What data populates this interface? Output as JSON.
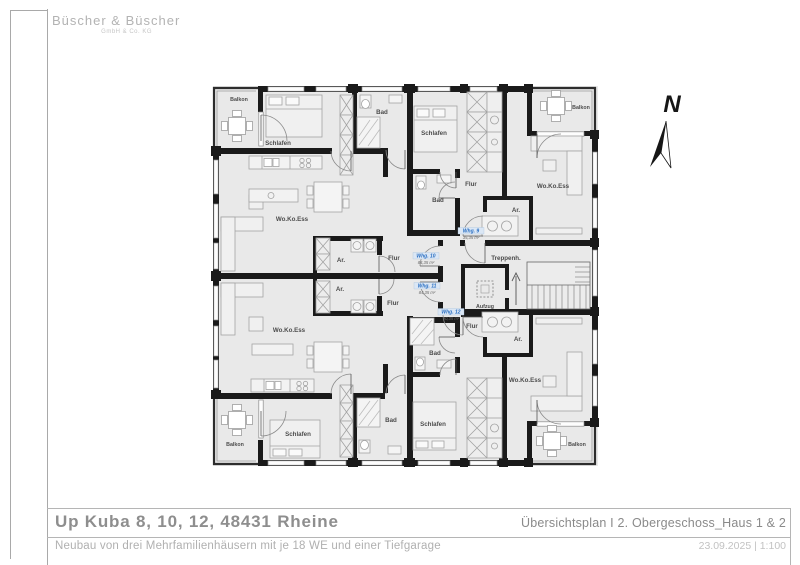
{
  "branding": {
    "company": "Büscher & Büscher",
    "company_suffix": "GmbH & Co. KG"
  },
  "title_block": {
    "project_title": "Up Kuba 8, 10, 12, 48431 Rheine",
    "project_subtitle": "Neubau von drei Mehrfamilienhäusern mit je 18 WE und einer Tiefgarage",
    "plan_title": "Übersichtsplan I 2. Obergeschoss_Haus 1 & 2",
    "date_and_scale": "23.09.2025 | 1:100"
  },
  "compass": {
    "north_label": "N"
  },
  "plan": {
    "room_labels": {
      "balkon": "Balkon",
      "schlafen": "Schlafen",
      "bad": "Bad",
      "wohnen_kochen_essen": "Wo.Ko.Ess",
      "flur": "Flur",
      "abstellraum": "Ar.",
      "treppenhaus": "Treppenh.",
      "aufzug": "Aufzug"
    },
    "apartments": [
      {
        "id": "Whg. 9",
        "area": "35,35 m²"
      },
      {
        "id": "Whg. 10",
        "area": "84,35 m²"
      },
      {
        "id": "Whg. 11",
        "area": "84,35 m²"
      },
      {
        "id": "Whg. 12",
        "area": "90,35 m²"
      }
    ],
    "colors": {
      "wall": "#1a1a1a",
      "floor_fill": "#e9e9e9",
      "furniture_stroke": "#a3a3a3",
      "room_label": "#4c4c4c",
      "apartment_label": "#2a6fc2"
    }
  }
}
